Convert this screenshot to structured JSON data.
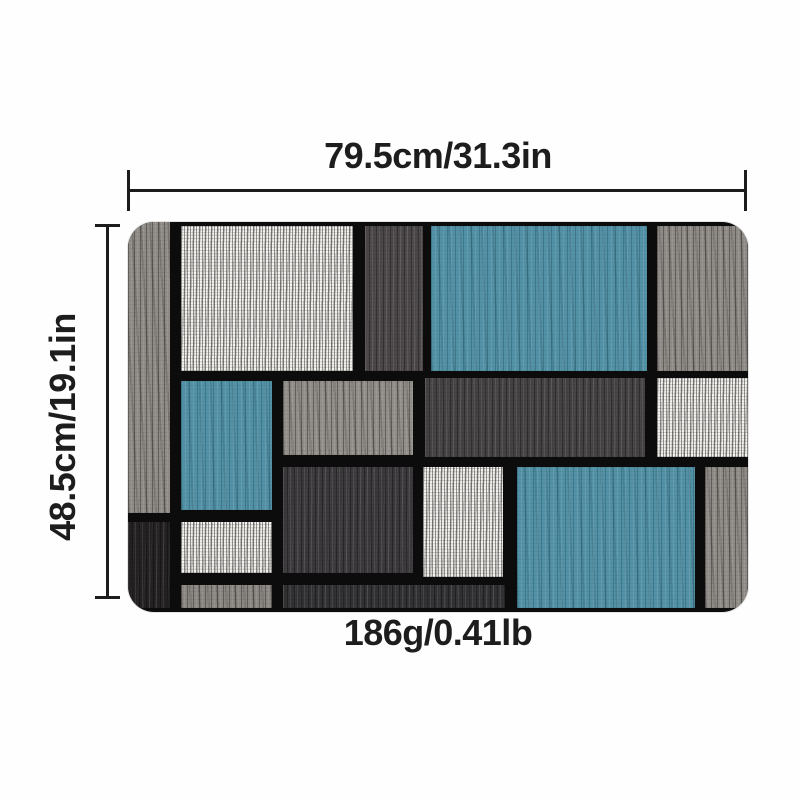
{
  "annotations": {
    "width_label": "79.5cm/31.3in",
    "height_label": "48.5cm/19.1in",
    "weight_label": "186g/0.41lb",
    "text_color": "#1d1d1d",
    "line_color": "#1c1c1c"
  },
  "mat": {
    "base_color": "#0d0c0c",
    "colors": {
      "blue": "#5392a6",
      "gray": "#8f8b86",
      "gray_light": "#928e89",
      "gray_dim": "#8b8782",
      "white": "#f4f3f0",
      "dark_slate": "#4a4648",
      "dark_charcoal": "#444143",
      "dark_deep": "#3a383a",
      "dark_strip": "#313032",
      "near_black": "#232122"
    },
    "regions": [
      {
        "name": "left-column-gray",
        "color": "gray",
        "texture": "soft",
        "x": 0,
        "y": 0,
        "w": 42,
        "h": 291
      },
      {
        "name": "left-column-black",
        "color": "near_black",
        "texture": "dark",
        "x": 0,
        "y": 300,
        "w": 42,
        "h": 86
      },
      {
        "name": "white-top",
        "color": "white",
        "texture": "white",
        "x": 53,
        "y": 4,
        "w": 172,
        "h": 145
      },
      {
        "name": "darkgray-top",
        "color": "dark_slate",
        "texture": "dark",
        "x": 237,
        "y": 4,
        "w": 58,
        "h": 145
      },
      {
        "name": "blue-top",
        "color": "blue",
        "texture": "blue",
        "x": 303,
        "y": 4,
        "w": 216,
        "h": 145
      },
      {
        "name": "gray-top-right",
        "color": "gray",
        "texture": "soft",
        "x": 529,
        "y": 4,
        "w": 91,
        "h": 145
      },
      {
        "name": "blue-mid-left",
        "color": "blue",
        "texture": "blue",
        "x": 53,
        "y": 159,
        "w": 91,
        "h": 129
      },
      {
        "name": "gray-mid",
        "color": "gray_light",
        "texture": "soft",
        "x": 155,
        "y": 159,
        "w": 130,
        "h": 74
      },
      {
        "name": "dark-big-mid",
        "color": "dark_charcoal",
        "texture": "dark",
        "x": 297,
        "y": 156,
        "w": 220,
        "h": 79
      },
      {
        "name": "white-mid-right",
        "color": "white",
        "texture": "white",
        "x": 529,
        "y": 156,
        "w": 91,
        "h": 79
      },
      {
        "name": "dark-mid",
        "color": "dark_deep",
        "texture": "dark",
        "x": 155,
        "y": 245,
        "w": 130,
        "h": 106
      },
      {
        "name": "white-mid-center",
        "color": "white",
        "texture": "white",
        "x": 295,
        "y": 245,
        "w": 80,
        "h": 110
      },
      {
        "name": "blue-big-bottom",
        "color": "blue",
        "texture": "blue",
        "x": 389,
        "y": 245,
        "w": 178,
        "h": 141
      },
      {
        "name": "gray-bottom-right",
        "color": "gray",
        "texture": "soft",
        "x": 577,
        "y": 245,
        "w": 43,
        "h": 141
      },
      {
        "name": "white-bottom-left",
        "color": "white",
        "texture": "white",
        "x": 53,
        "y": 300,
        "w": 91,
        "h": 51
      },
      {
        "name": "gray-strip-bottom-left",
        "color": "gray_dim",
        "texture": "soft",
        "x": 53,
        "y": 363,
        "w": 91,
        "h": 23
      },
      {
        "name": "dark-strip-bottom",
        "color": "dark_strip",
        "texture": "dark",
        "x": 155,
        "y": 363,
        "w": 222,
        "h": 23
      }
    ]
  }
}
